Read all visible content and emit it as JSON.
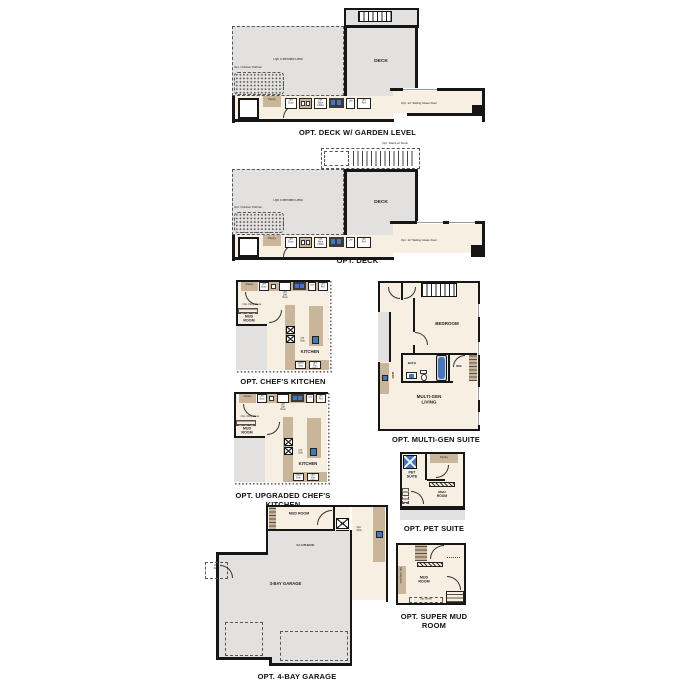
{
  "page": {
    "background": "#ffffff"
  },
  "colors": {
    "floor": "#f6efe2",
    "deck": "#e2e1df",
    "cabinet": "#c9b59a",
    "wall": "#161616",
    "fixture_blue": "#4677b8"
  },
  "plans": {
    "deck_garden": {
      "title": "OPT. DECK W/ GARDEN LEVEL",
      "deck": "DECK",
      "extended_deck": "Opt. Extended Deck",
      "outdoor_kitchen": "Opt. Outdoor Kitchen",
      "sliding_door": "Opt. 12' Sliding Glass Door",
      "pantry": "Pantry",
      "opt_door": "Opt. Door",
      "wine_chiller": "Opt. Wine Chiller",
      "dw": "DW",
      "opt_ref": "Opt. Ref."
    },
    "deck": {
      "title": "OPT. DECK",
      "stairs": "Opt. Stairs w/ Deck",
      "deck": "DECK",
      "extended_deck": "Opt. Extended Deck",
      "outdoor_kitchen": "Opt. Outdoor Kitchen",
      "sliding_door": "Opt. 12' Sliding Glass Door",
      "pantry": "Pantry",
      "opt_door": "Opt. Door",
      "wine_chiller": "Opt. Wine Chiller",
      "dw": "DW",
      "opt_ref": "Opt. Ref."
    },
    "chefs_kitchen": {
      "title": "OPT. CHEF'S KITCHEN",
      "mud_room": "MUD ROOM",
      "kitchen": "KITCHEN",
      "pantry": "Pantry",
      "drop_zone": "Opt. Drop Zone",
      "opt_door": "Opt. Door",
      "dbl_oven": "Opt. Dbl Oven",
      "dw": "DW",
      "opt_ref": "Opt. Ref.",
      "opt_sink": "Opt. Sink",
      "super_sink": "Super Sink",
      "pot_filler": "Opt. Pot Filler"
    },
    "multi_gen": {
      "title": "OPT. MULTI-GEN SUITE",
      "bedroom": "BEDROOM",
      "bath": "BATH",
      "wic": "WIC",
      "living": "MULTI-GEN LIVING",
      "bar": "BAR"
    },
    "upgraded_kitchen": {
      "title": "OPT. UPGRADED CHEF'S KITCHEN",
      "mud_room": "MUD ROOM",
      "kitchen": "KITCHEN",
      "pantry": "Pantry",
      "drop_zone": "Opt. Drop Zone",
      "opt_door": "Opt. Door",
      "dbl_oven": "Opt. Dbl Oven",
      "dw": "DW",
      "opt_ref": "Opt. Ref.",
      "opt_sink": "Opt. Sink",
      "super_sink": "Super Sink",
      "pot_filler": "Opt. Pot Filler"
    },
    "pet_suite": {
      "title": "OPT. PET SUITE",
      "pet_suite": "PET SUITE",
      "mud_room": "MUD ROOM",
      "pantry": "Pantry"
    },
    "garage": {
      "title": "OPT. 4-BAY GARAGE",
      "mud_room": "MUD ROOM",
      "storage": "STORAGE",
      "bays": "3-BAY GARAGE",
      "opt_door": "Opt. Door",
      "opt_sink": "Opt. Sink"
    },
    "super_mud_room": {
      "title": "OPT. SUPER MUD ROOM",
      "mud_room": "MUD ROOM",
      "drop_zone": "Opt. Drop Zone",
      "opt_bench": "Opt. Bench"
    }
  }
}
